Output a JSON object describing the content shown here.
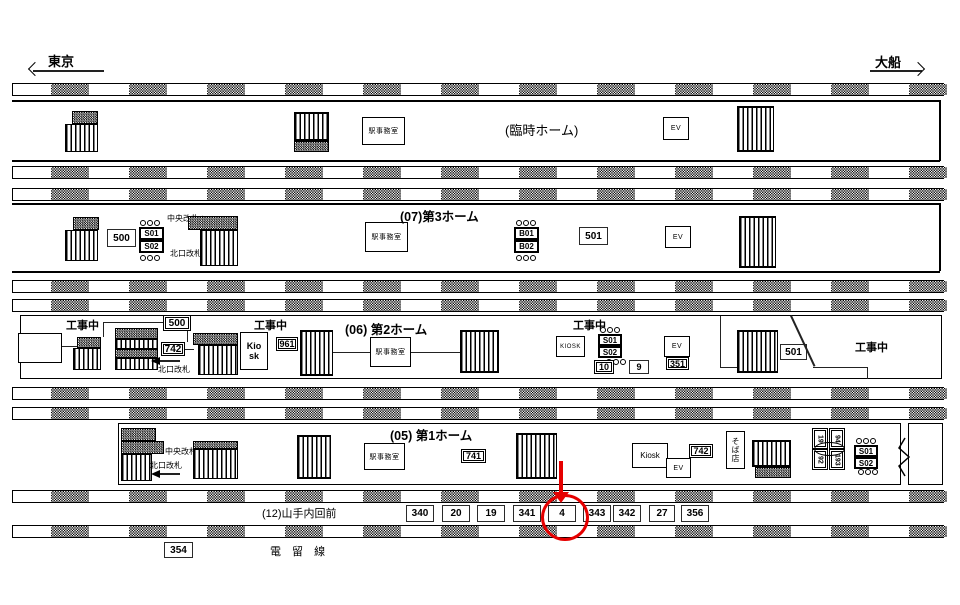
{
  "colors": {
    "ink": "#000000",
    "highlight": "#e60000",
    "paper": "#ffffff"
  },
  "directions": {
    "left": "東京",
    "right": "大船"
  },
  "common": {
    "office": "駅事務室",
    "ev": "EV",
    "construction": "工事中",
    "north_gate": "北口改札",
    "central_gate": "中央改札",
    "central_gate_to": "中央改札へ",
    "soba_shop": "そば店",
    "kiosk_two_line_1": "Kio",
    "kiosk_two_line_2": "sk",
    "kiosk_caps": "KIOSK",
    "kiosk": "Kiosk"
  },
  "platform_temp": {
    "title": "(臨時ホーム)"
  },
  "platform3": {
    "title": "(07)第3ホーム",
    "ad_500": "500",
    "ad_501": "501",
    "esc_s01": "S01",
    "esc_s02": "S02",
    "esc_b01": "B01",
    "esc_b02": "B02"
  },
  "platform2": {
    "title": "(06) 第2ホーム",
    "ad_500": "500",
    "ad_742": "742",
    "ad_961": "961",
    "ad_10": "10",
    "ad_9": "9",
    "ad_351": "351",
    "ad_501": "501",
    "esc_s01": "S01",
    "esc_s02": "S02"
  },
  "platform1": {
    "title": "(05) 第1ホーム",
    "ad_741": "741",
    "ad_742": "742",
    "rotated_ads": [
      "19",
      "94",
      "92",
      "193"
    ],
    "esc_s01": "S01",
    "esc_s02": "S02"
  },
  "bottom": {
    "area_label": "(12)山手内回前",
    "ads": [
      "340",
      "20",
      "19",
      "341",
      "4",
      "343",
      "342",
      "27",
      "356"
    ],
    "highlighted_ad": "4",
    "ad_354": "354",
    "siding_label": "電 留 線"
  }
}
